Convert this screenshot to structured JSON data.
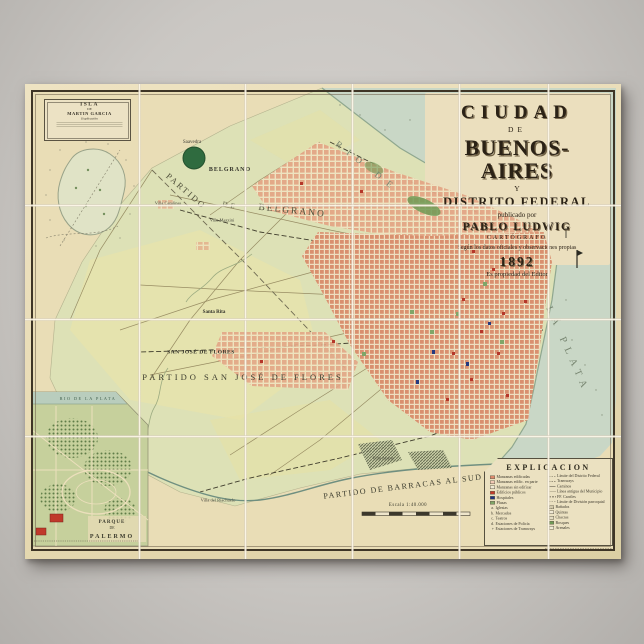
{
  "poster": {
    "title_block": {
      "line_city": "CIUDAD",
      "line_de": "DE",
      "line_name": "BUENOS-AIRES",
      "line_y": "Y",
      "line_district": "DISTRITO FEDERAL",
      "line_published": "publicado por",
      "line_author": "PABLO LUDWIG",
      "line_author_title": "CARTÓGRAFO",
      "line_note": "Según los datos oficiales y observaciones propias",
      "line_year": "1892",
      "line_copyright": "Es propiedad del Editor"
    },
    "inset_isla": {
      "title_line1": "ISLA",
      "title_line2": "DE",
      "title_line3": "MARTIN GARCIA",
      "subtitle": "Explicación"
    },
    "inset_palermo": {
      "water_label": "RIO DE LA PLATA",
      "name_line1": "PARQUE",
      "name_line2": "DE",
      "name_line3": "PALERMO"
    },
    "legend": {
      "title": "EXPLICACION",
      "col1": [
        {
          "sw": "#dd8a6d",
          "label": "Manzanas edificadas"
        },
        {
          "sw": "#f2c9b5",
          "label": "Manzanas edific. en parte"
        },
        {
          "sw": "outline",
          "label": "Manzanas sin edificar"
        },
        {
          "sw": "#c23b2a",
          "label": "Edificios públicos"
        },
        {
          "sw": "#22357d",
          "label": "Hospitales"
        },
        {
          "sw": "#7fa668",
          "label": "Plazas"
        },
        {
          "pre": "a.",
          "label": "Iglesias"
        },
        {
          "pre": "b.",
          "label": "Mercados"
        },
        {
          "pre": "c.",
          "label": "Teatros"
        },
        {
          "pre": "d.",
          "label": "Estaciones de Policía"
        },
        {
          "pre": "+",
          "label": "Estaciones de Tramways"
        }
      ],
      "col2": [
        {
          "line": "dashdot",
          "label": "Límite del Distrito Federal"
        },
        {
          "line": "dash",
          "label": "Tramways"
        },
        {
          "line": "solid",
          "label": "Caminos"
        },
        {
          "line": "dot",
          "label": "Línea antigua del Municipio"
        },
        {
          "line": "rail",
          "label": "FF. Carriles"
        },
        {
          "line": "dashfine",
          "label": "Límite de División parroquial"
        },
        {
          "sw": "hatch",
          "label": "Bañados"
        },
        {
          "sw": "outline",
          "label": "Quintas"
        },
        {
          "sw": "#e4ddc2",
          "label": "Chacras"
        },
        {
          "sw": "#6f9a55",
          "label": "Bosques"
        },
        {
          "sw": "#efe9d2",
          "label": "Arenales"
        }
      ]
    },
    "map_labels": [
      {
        "t": "PARTIDO",
        "x": 186,
        "y": 191,
        "s": 8.5,
        "r": 41,
        "ls": 2,
        "c": "#4f4f3a"
      },
      {
        "t": "DE",
        "x": 230,
        "y": 206,
        "s": 7,
        "r": 12,
        "ls": 3,
        "c": "#4f4f3a"
      },
      {
        "t": "BELGRANO",
        "x": 292,
        "y": 212,
        "s": 9.5,
        "r": 6,
        "ls": 2,
        "c": "#4f4f3a"
      },
      {
        "t": "BELGRANO",
        "x": 230,
        "y": 169,
        "s": 6,
        "r": 0,
        "ls": 1,
        "c": "#32322a",
        "b": 1
      },
      {
        "t": "Saavedra",
        "x": 192,
        "y": 142,
        "s": 5,
        "r": 0,
        "ls": 0,
        "c": "#45453b"
      },
      {
        "t": "Villa Catalinas",
        "x": 168,
        "y": 203,
        "s": 4.5,
        "r": 0,
        "ls": 0,
        "c": "#45453b"
      },
      {
        "t": "Villa Mazzini",
        "x": 222,
        "y": 220,
        "s": 4.5,
        "r": 0,
        "ls": 0,
        "c": "#45453b"
      },
      {
        "t": "Santa Rita",
        "x": 214,
        "y": 312,
        "s": 5,
        "r": 0,
        "ls": 0,
        "c": "#32322a",
        "b": 1
      },
      {
        "t": "SAN JOSÉ DE FLORES",
        "x": 201,
        "y": 352,
        "s": 5.5,
        "r": 0,
        "ls": 0.5,
        "c": "#2f2f26",
        "b": 1
      },
      {
        "t": "PARTIDO SAN JOSÉ DE FLORES",
        "x": 243,
        "y": 377,
        "s": 8.5,
        "r": 0,
        "ls": 3,
        "c": "#3d3d2f"
      },
      {
        "t": "PARTIDO DE BARRACAS AL SUD",
        "x": 403,
        "y": 487,
        "s": 8,
        "r": -7,
        "ls": 1.5,
        "c": "#3d3d2f"
      },
      {
        "t": "RIO DE",
        "x": 367,
        "y": 167,
        "s": 9,
        "r": 38,
        "ls": 8,
        "c": "#76846f"
      },
      {
        "t": "LA PLATA",
        "x": 567,
        "y": 350,
        "s": 10,
        "r": 66,
        "ls": 6,
        "c": "#76846f"
      },
      {
        "t": "Villa Alsina",
        "x": 383,
        "y": 458,
        "s": 4.5,
        "r": 0,
        "ls": 0,
        "c": "#45453b"
      },
      {
        "t": "Villa del Riachuelo",
        "x": 218,
        "y": 500,
        "s": 4.5,
        "r": 0,
        "ls": 0,
        "c": "#45453b"
      },
      {
        "t": "Escala 1:40.000",
        "x": 408,
        "y": 505,
        "s": 4.8,
        "r": 0,
        "ls": 0.5,
        "c": "#3d3d2f"
      },
      {
        "t": "RIO DE LA PLATA",
        "x": 88,
        "y": 399,
        "s": 4.2,
        "r": 0,
        "ls": 1.5,
        "c": "#42604e"
      },
      {
        "t": "PARQUE",
        "x": 112,
        "y": 522,
        "s": 5,
        "r": 0,
        "ls": 1,
        "c": "#3a3a2c",
        "b": 1
      },
      {
        "t": "DE",
        "x": 112,
        "y": 528,
        "s": 3.8,
        "r": 0,
        "ls": 0,
        "c": "#3a3a2c"
      },
      {
        "t": "PALERMO",
        "x": 112,
        "y": 536,
        "s": 6,
        "r": 0,
        "ls": 2,
        "c": "#3a3a2c",
        "b": 1
      }
    ]
  }
}
